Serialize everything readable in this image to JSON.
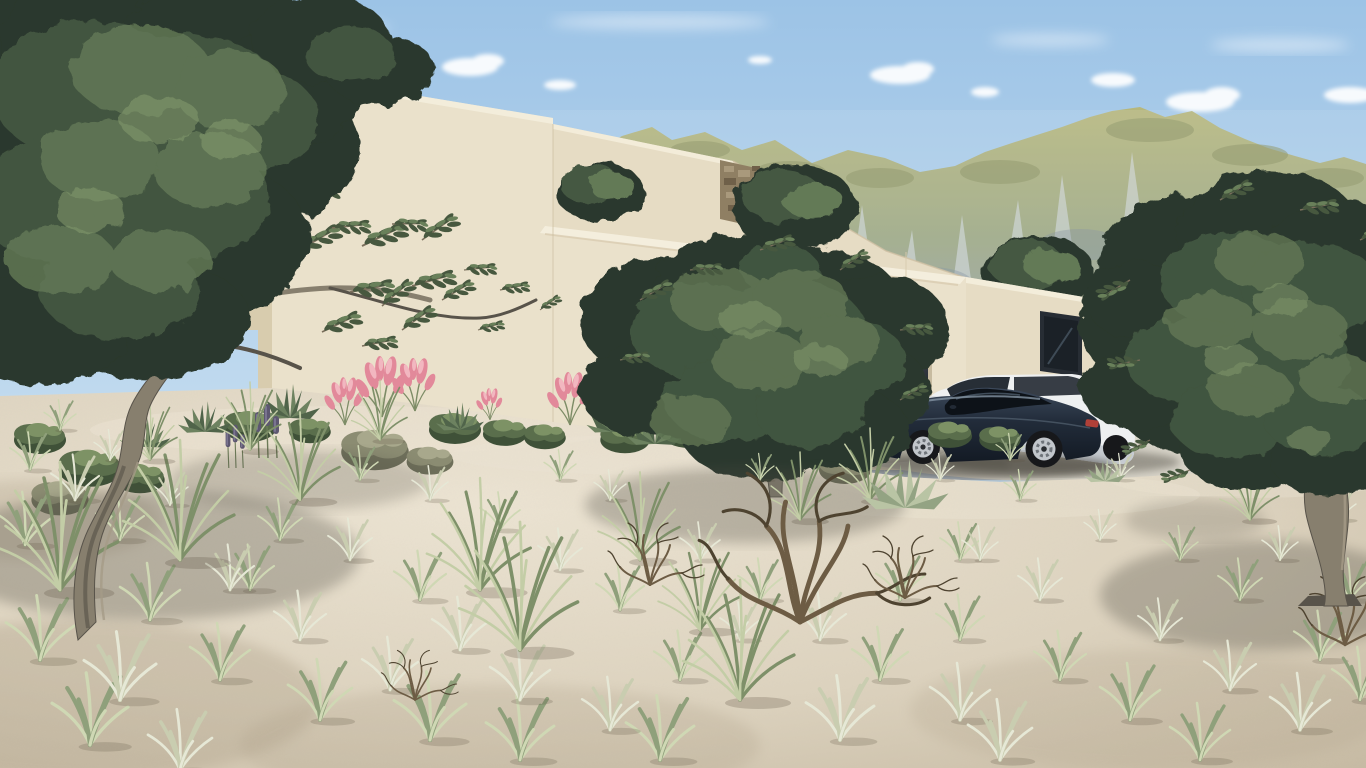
{
  "scene": {
    "description": "Sunny 3D architectural exterior rendering: modern flat-roofed beige villa on a sandy hillside with sparse grasses, olive trees, a rocky green mountain range behind, and two cars parked on a concrete driveway",
    "objects": [
      {
        "name": "villa",
        "parts": [
          "tall-left-volume",
          "middle-volume",
          "stone-clad-insert",
          "front-courtyard-wall",
          "garage-volume",
          "right-low-volume"
        ]
      },
      {
        "name": "garage-door",
        "appearance": "dark recessed"
      },
      {
        "name": "window",
        "appearance": "dark glazed, right volume"
      },
      {
        "name": "dark-sports-car",
        "appearance": "dark navy four-door coupe, silver alloy wheels"
      },
      {
        "name": "white-suv",
        "appearance": "white estate/SUV parked behind sports car"
      },
      {
        "name": "olive-tree-left",
        "appearance": "large gnarled olive tree, top-left foreground"
      },
      {
        "name": "olive-tree-middle",
        "appearance": "olive tree in front of garage volume"
      },
      {
        "name": "olive-tree-right",
        "appearance": "olive tree right foreground with twisted trunk"
      },
      {
        "name": "dead-shrub",
        "appearance": "dry twiggy tumbleweed, bottom centre"
      },
      {
        "name": "pink-flower-shrubs",
        "appearance": "pink plume grasses along wall base"
      },
      {
        "name": "mountains",
        "appearance": "grey limestone cliffs with yellow-green grassy tops"
      },
      {
        "name": "sky",
        "appearance": "light blue with small white clouds"
      }
    ]
  },
  "palette": {
    "sky_top": "#9cc3e6",
    "sky_mid": "#c2dbef",
    "sky_low": "#e6eff6",
    "cloud": "#ffffff",
    "mtn_green": "#b7b77c",
    "mtn_green_dark": "#8a9160",
    "mtn_rock": "#93a0af",
    "mtn_rock_light": "#d9dfe8",
    "mtn_rock_dark": "#7e8b98",
    "mtn_hill": "#aeac72",
    "wall_lit": "#eae1cb",
    "wall_lit2": "#e6dcc4",
    "wall_shade": "#d8ccae",
    "wall_dark": "#c7bba0",
    "coping": "#f4eedd",
    "ao": "#cdbfa2",
    "stone": "#8f7f63",
    "stone_light": "#a9997c",
    "stone_dark": "#6f6049",
    "garage_top": "#4a525c",
    "garage_bot": "#15191f",
    "window": "#1b2127",
    "winframe": "#272d34",
    "drive": "#d9d5ca",
    "drive_light": "#e3dfd5",
    "drive_shade": "#b7b2a6",
    "sand": "#ddd3bf",
    "sand_light": "#ece4d3",
    "sand_dark": "#bfb29a",
    "sand_shadow": "#a89a82",
    "f_dark": "#2c392d",
    "f_mid": "#455943",
    "f_light": "#647a57",
    "f_hi": "#8aa072",
    "trunk": "#877f6e",
    "trunk_dark": "#58534a",
    "trunk_light": "#a59b87",
    "car_top": "#3d4a5c",
    "car_bot": "#131a24",
    "car_hi": "#8595a4",
    "glass": "#0d1218",
    "glass_hi": "#4e5d6b",
    "rim": "#c2c6cb",
    "tire": "#17181b",
    "tail": "#b04038",
    "suv": "#eef0f1",
    "suv_shade": "#c6cbd1",
    "suv_glass": "#272e36",
    "shadow": "#4d4c42"
  },
  "scatter_layers": [
    {
      "name": "band-shrub-green",
      "container": "scatter-band",
      "symbol": "shrub",
      "vars": {
        "--s1": "#3f5138",
        "--s2": "#5a6e4c",
        "--s3": "#7d9265"
      },
      "items": [
        [
          250,
          428,
          1.0
        ],
        [
          310,
          432,
          0.8
        ],
        [
          455,
          430,
          1.0
        ],
        [
          505,
          434,
          0.85
        ],
        [
          545,
          438,
          0.8
        ],
        [
          625,
          440,
          0.95
        ],
        [
          690,
          432,
          1.15
        ],
        [
          735,
          440,
          1.0
        ],
        [
          795,
          432,
          1.25
        ],
        [
          950,
          436,
          0.85
        ],
        [
          1000,
          440,
          0.8
        ],
        [
          90,
          470,
          1.2
        ],
        [
          40,
          440,
          1.0
        ],
        [
          140,
          480,
          0.95
        ],
        [
          700,
          392,
          0.9
        ],
        [
          745,
          398,
          0.8
        ],
        [
          825,
          420,
          0.9
        ]
      ]
    },
    {
      "name": "band-shrub-grey",
      "container": "scatter-band",
      "symbol": "shrub",
      "vars": {
        "--s1": "#6e6f5a",
        "--s2": "#8b8c72",
        "--s3": "#a8a88c"
      },
      "items": [
        [
          375,
          452,
          1.3
        ],
        [
          430,
          462,
          0.9
        ],
        [
          845,
          470,
          1.0
        ],
        [
          60,
          500,
          1.1
        ]
      ]
    },
    {
      "name": "pink-plume-shrub",
      "container": "scatter-band",
      "symbol": "pinkplume",
      "vars": {
        "--p1": "#e2899a",
        "--p2": "#f2b7c0",
        "--pg": "#7d8c66"
      },
      "items": [
        [
          345,
          425,
          0.9
        ],
        [
          382,
          417,
          1.15
        ],
        [
          415,
          411,
          1.0
        ],
        [
          490,
          420,
          0.6
        ],
        [
          570,
          425,
          1.0
        ],
        [
          665,
          430,
          0.9
        ]
      ]
    },
    {
      "name": "red-plume-shrub",
      "container": "scatter-band",
      "symbol": "pinkplume",
      "vars": {
        "--p1": "#c65f5f",
        "--p2": "#e09090",
        "--pg": "#6d7c58"
      },
      "items": [
        [
          1140,
          405,
          0.9
        ],
        [
          1122,
          412,
          0.6
        ]
      ]
    },
    {
      "name": "agave-plant",
      "container": "scatter-band",
      "symbol": "agave",
      "vars": {
        "--a1": "#50644a",
        "--a2": "#6d8260"
      },
      "items": [
        [
          290,
          416,
          1.0
        ],
        [
          205,
          430,
          0.9
        ],
        [
          460,
          428,
          0.8
        ],
        [
          612,
          430,
          0.85
        ],
        [
          655,
          442,
          0.95
        ],
        [
          735,
          450,
          0.7
        ],
        [
          145,
          445,
          0.85
        ]
      ]
    },
    {
      "name": "purple-plume-plant",
      "container": "scatter-band",
      "symbol": "plume",
      "vars": {
        "--u1": "#5d5770",
        "--u2": "#7a7490",
        "--pg": "#6d7c58"
      },
      "items": [
        [
          268,
          458,
          1.0
        ],
        [
          236,
          468,
          0.8
        ]
      ]
    },
    {
      "name": "overhang-leaf-sprig",
      "container": "g-overhang",
      "symbol": "sprig",
      "vars": {
        "--f1": "#47583f",
        "--f2": "#69805a",
        "--t1": "#7a6f5c"
      },
      "items": [
        [
          300,
          250,
          1.5,
          -10
        ],
        [
          332,
          228,
          1.3,
          15
        ],
        [
          362,
          246,
          1.6,
          -5
        ],
        [
          392,
          224,
          1.2,
          20
        ],
        [
          422,
          240,
          1.4,
          -15
        ],
        [
          350,
          292,
          1.5,
          10
        ],
        [
          382,
          306,
          1.3,
          -20
        ],
        [
          412,
          286,
          1.5,
          5
        ],
        [
          442,
          300,
          1.2,
          -10
        ],
        [
          464,
          270,
          1.1,
          15
        ],
        [
          322,
          332,
          1.4,
          -5
        ],
        [
          362,
          346,
          1.2,
          10
        ],
        [
          402,
          330,
          1.3,
          -15
        ],
        [
          302,
          190,
          1.3,
          20
        ],
        [
          272,
          212,
          1.4,
          -10
        ],
        [
          500,
          290,
          1.0,
          10
        ],
        [
          540,
          310,
          0.8,
          -15
        ],
        [
          478,
          330,
          0.9,
          5
        ]
      ]
    },
    {
      "name": "midtree-leaf-sprig",
      "container": "g-mid-fringe",
      "symbol": "sprig",
      "vars": {
        "--f1": "#47583f",
        "--f2": "#69805a",
        "--t1": "#7a6f5c"
      },
      "items": [
        [
          640,
          300,
          1.2,
          -10
        ],
        [
          900,
          330,
          1.1,
          15
        ],
        [
          620,
          360,
          1.0,
          10
        ],
        [
          900,
          400,
          1.0,
          -10
        ],
        [
          760,
          250,
          1.2,
          0
        ],
        [
          840,
          270,
          1.1,
          -15
        ],
        [
          690,
          270,
          1.1,
          15
        ]
      ]
    },
    {
      "name": "righttree-leaf-sprig",
      "container": "g-right-fringe",
      "symbol": "sprig",
      "vars": {
        "--f1": "#47583f",
        "--f2": "#69805a",
        "--t1": "#7a6f5c"
      },
      "items": [
        [
          1130,
          280,
          1.2,
          170
        ],
        [
          1140,
          360,
          1.1,
          190
        ],
        [
          1150,
          440,
          1.0,
          175
        ],
        [
          1220,
          200,
          1.2,
          -10
        ],
        [
          1300,
          210,
          1.3,
          10
        ],
        [
          1360,
          240,
          1.1,
          -5
        ],
        [
          1190,
          470,
          1.0,
          180
        ]
      ]
    },
    {
      "name": "grass-tuft-green",
      "container": "scatter-ground",
      "symbol": "tuft",
      "vars": {
        "--g1": "#8fa07b",
        "--g2": "#cfd8b4"
      },
      "items": [
        [
          30,
          470,
          1.0
        ],
        [
          120,
          540,
          1.2
        ],
        [
          25,
          545,
          1.4
        ],
        [
          150,
          620,
          1.5
        ],
        [
          40,
          660,
          1.7
        ],
        [
          220,
          680,
          1.5
        ],
        [
          90,
          745,
          1.9
        ],
        [
          320,
          720,
          1.6
        ],
        [
          280,
          540,
          1.1
        ],
        [
          420,
          600,
          1.3
        ],
        [
          430,
          740,
          1.8
        ],
        [
          620,
          610,
          1.2
        ],
        [
          680,
          680,
          1.3
        ],
        [
          520,
          760,
          1.7
        ],
        [
          760,
          600,
          1.1
        ],
        [
          900,
          600,
          1.2
        ],
        [
          960,
          640,
          1.2
        ],
        [
          880,
          680,
          1.4
        ],
        [
          1060,
          680,
          1.3
        ],
        [
          1240,
          600,
          1.1
        ],
        [
          1130,
          720,
          1.5
        ],
        [
          1320,
          660,
          1.3
        ],
        [
          1350,
          600,
          1.1
        ],
        [
          1180,
          560,
          0.9
        ],
        [
          1020,
          500,
          0.8
        ],
        [
          1010,
          460,
          0.7
        ],
        [
          560,
          480,
          0.8
        ],
        [
          360,
          480,
          0.9
        ],
        [
          500,
          530,
          1.0
        ],
        [
          760,
          480,
          0.7
        ],
        [
          660,
          760,
          1.7
        ],
        [
          1200,
          760,
          1.5
        ],
        [
          1360,
          700,
          1.4
        ],
        [
          60,
          430,
          0.8
        ],
        [
          250,
          590,
          1.2
        ],
        [
          960,
          560,
          1.0
        ]
      ]
    },
    {
      "name": "grass-tuft-dry",
      "container": "scatter-ground",
      "symbol": "tuft",
      "vars": {
        "--g1": "#c9cdb0",
        "--g2": "#e6e8d6"
      },
      "items": [
        [
          75,
          500,
          1.2
        ],
        [
          170,
          505,
          0.9
        ],
        [
          230,
          590,
          1.2
        ],
        [
          120,
          700,
          1.8
        ],
        [
          300,
          640,
          1.3
        ],
        [
          390,
          690,
          1.4
        ],
        [
          350,
          560,
          1.1
        ],
        [
          460,
          650,
          1.4
        ],
        [
          520,
          700,
          1.5
        ],
        [
          610,
          730,
          1.4
        ],
        [
          430,
          500,
          0.9
        ],
        [
          560,
          570,
          1.1
        ],
        [
          700,
          560,
          1.0
        ],
        [
          820,
          640,
          1.3
        ],
        [
          980,
          560,
          0.9
        ],
        [
          1040,
          600,
          1.1
        ],
        [
          960,
          720,
          1.5
        ],
        [
          1160,
          640,
          1.1
        ],
        [
          1230,
          690,
          1.3
        ],
        [
          1300,
          730,
          1.5
        ],
        [
          1280,
          560,
          0.9
        ],
        [
          1100,
          540,
          0.8
        ],
        [
          940,
          480,
          0.7
        ],
        [
          1120,
          480,
          0.7
        ],
        [
          610,
          500,
          0.8
        ],
        [
          110,
          460,
          0.8
        ],
        [
          840,
          740,
          1.7
        ],
        [
          1000,
          760,
          1.6
        ],
        [
          180,
          770,
          1.6
        ],
        [
          740,
          640,
          1.0
        ],
        [
          1340,
          520,
          0.8
        ]
      ]
    },
    {
      "name": "tall-grass-clump",
      "container": "scatter-ground",
      "symbol": "tuftTall",
      "vars": {
        "--g1": "#7e9069",
        "--g2": "#c3cda6"
      },
      "items": [
        [
          180,
          560,
          1.5
        ],
        [
          300,
          500,
          1.1
        ],
        [
          480,
          590,
          1.4
        ],
        [
          520,
          650,
          1.6
        ],
        [
          640,
          560,
          1.1
        ],
        [
          250,
          450,
          0.85
        ],
        [
          380,
          440,
          0.75
        ],
        [
          150,
          460,
          0.75
        ],
        [
          870,
          500,
          0.9
        ],
        [
          800,
          520,
          0.85
        ],
        [
          700,
          630,
          1.1
        ],
        [
          740,
          700,
          1.5
        ],
        [
          1250,
          520,
          0.8
        ],
        [
          60,
          590,
          1.6
        ]
      ]
    },
    {
      "name": "yucca-plant",
      "container": "scatter-ground",
      "symbol": "agave",
      "vars": {
        "--a1": "#93a383",
        "--a2": "#b9c4a4"
      },
      "items": [
        [
          905,
          505,
          1.45
        ],
        [
          1105,
          480,
          0.7
        ]
      ]
    },
    {
      "name": "dead-shrub",
      "container": "scatter-ground",
      "symbol": "deadbush",
      "vars": {
        "--d1": "#6d5c44",
        "--d2": "#4e4330"
      },
      "items": [
        [
          800,
          622,
          2.4
        ],
        [
          905,
          598,
          1.0
        ],
        [
          1345,
          645,
          1.1
        ],
        [
          415,
          700,
          0.8
        ],
        [
          650,
          585,
          1.0
        ]
      ]
    }
  ]
}
